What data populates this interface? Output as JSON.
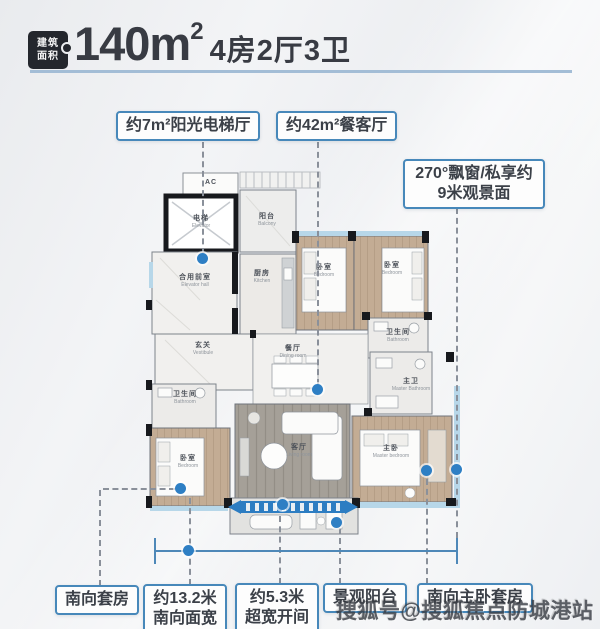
{
  "header": {
    "badge_line1": "建筑",
    "badge_line2": "面积",
    "area_value": "140m",
    "area_sup": "2",
    "layout_text": "4房2厅3卫"
  },
  "callouts": {
    "elevator_hall": "约7m²阳光电梯厅",
    "dining_living": "约42m²餐客厅",
    "bay_window_line1": "270°飘窗/私享约",
    "bay_window_line2": "9米观景面",
    "south_suite": "南向套房",
    "south_width_line1": "约13.2米",
    "south_width_line2": "南向面宽",
    "wide_bay_line1": "约5.3米",
    "wide_bay_line2": "超宽开间",
    "view_balcony": "景观阳台",
    "south_master_suite": "南向主卧套房"
  },
  "rooms": {
    "ac": {
      "cn": "AC",
      "en": ""
    },
    "elevator": {
      "cn": "电梯",
      "en": "Elevator"
    },
    "elevator_hall": {
      "cn": "合用前室",
      "en": "Elevator hall"
    },
    "balcony_top": {
      "cn": "阳台",
      "en": "Balcony"
    },
    "kitchen": {
      "cn": "厨房",
      "en": "Kitchen"
    },
    "vestibule": {
      "cn": "玄关",
      "en": "Vestibule"
    },
    "bedroom_a": {
      "cn": "卧室",
      "en": "Bedroom"
    },
    "bedroom_b": {
      "cn": "卧室",
      "en": "Bedroom"
    },
    "bathroom_right": {
      "cn": "卫生间",
      "en": "Bathroom"
    },
    "dining": {
      "cn": "餐厅",
      "en": "Dining room"
    },
    "living": {
      "cn": "客厅",
      "en": "Living room"
    },
    "bathroom_left": {
      "cn": "卫生间",
      "en": "Bathroom"
    },
    "bedroom_c": {
      "cn": "卧室",
      "en": "Bedroom"
    },
    "master_bath": {
      "cn": "主卫",
      "en": "Master Bathroom"
    },
    "master_bedroom": {
      "cn": "主卧",
      "en": "Master bedroom"
    }
  },
  "watermark": "搜狐号@搜狐焦点防城港站",
  "colors": {
    "accent_border": "#4788ba",
    "dot_blue": "#2e7fc4",
    "band_blue": "#2d7dc2",
    "underline": "#a3bdd6",
    "wall_dark": "#17191d",
    "wood_floor": "#c3ac94",
    "window_band": "#b7d7e9"
  }
}
